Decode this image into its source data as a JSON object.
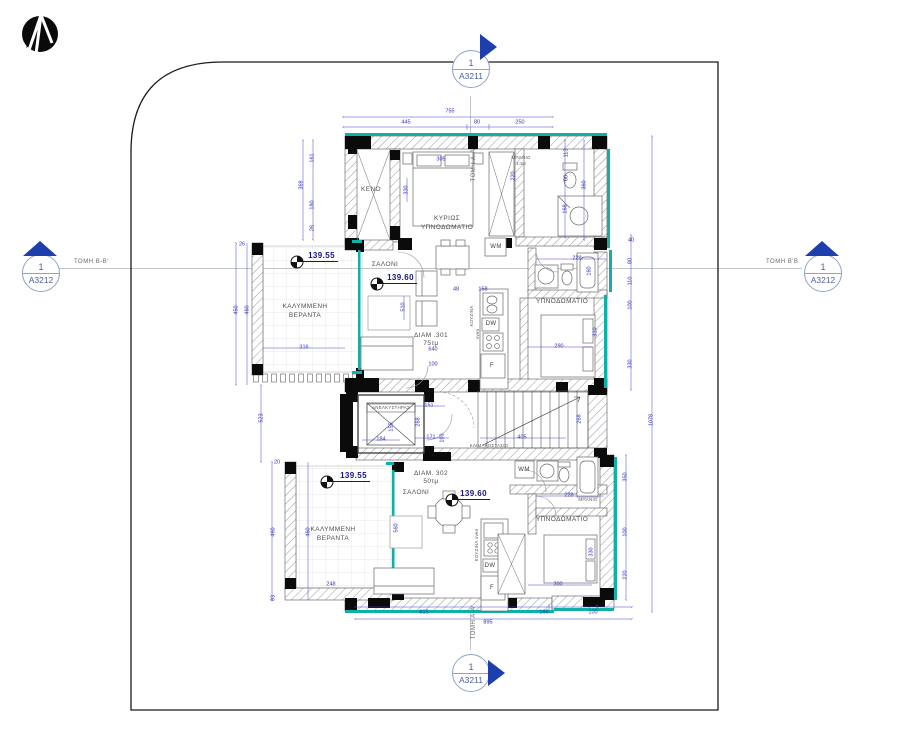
{
  "colors": {
    "dimension_blue": "#2f2fbe",
    "marker_blue": "#1d3fae",
    "wall_teal": "#0fb0a6",
    "level_navy": "#15157e"
  },
  "logo": {
    "name": "architect-logo"
  },
  "section_markers": {
    "top": {
      "number": "1",
      "sheet": "A3211",
      "label": "ΤΟΜΗ Α-Α"
    },
    "bottom": {
      "number": "1",
      "sheet": "A3211",
      "label": "ΤΟΜΗ Α-Α'"
    },
    "left": {
      "number": "1",
      "sheet": "A3212",
      "label": "ΤΟΜΗ Β-Β'"
    },
    "right": {
      "number": "1",
      "sheet": "A3212",
      "label": "ΤΟΜΗ Β'Β"
    }
  },
  "plan": {
    "apartments": [
      {
        "name": "ΔΙΑΜ .301",
        "area": "75τμ"
      },
      {
        "name": "ΔΙΑΜ. 302",
        "area": "50τμ"
      }
    ],
    "rooms": [
      {
        "t": "ΚΕΝΟ",
        "x": 371,
        "y": 190,
        "cls": "room"
      },
      {
        "t": "ΚΥΡΙΩΣ",
        "x": 447,
        "y": 219,
        "cls": "room"
      },
      {
        "t": "ΥΠΝΟΔΩΜΑΤΙΟ",
        "x": 447,
        "y": 228,
        "cls": "room"
      },
      {
        "t": "ΜΠΑΝΙΟ",
        "x": 521,
        "y": 158,
        "cls": "tiny"
      },
      {
        "t": "1:50",
        "x": 521,
        "y": 164,
        "cls": "tiny"
      },
      {
        "t": "ΣΑΛΟΝΙ",
        "x": 385,
        "y": 265,
        "cls": "room"
      },
      {
        "t": "ΚΑΛΥΜΜΕΝΗ",
        "x": 305,
        "y": 307,
        "cls": "room"
      },
      {
        "t": "ΒΕΡΑΝΤΑ",
        "x": 305,
        "y": 316,
        "cls": "room"
      },
      {
        "t": "ΥΠΝΟΔΩΜΑΤΙΟ",
        "x": 562,
        "y": 302,
        "cls": "room"
      },
      {
        "t": "ΔΙΑΜ .301",
        "x": 431,
        "y": 336,
        "cls": "room"
      },
      {
        "t": "75τμ",
        "x": 431,
        "y": 344,
        "cls": "room"
      },
      {
        "t": "ΚΟΥΖΙΝΑ",
        "x": 472,
        "y": 316,
        "cls": "tiny",
        "r": 1
      },
      {
        "t": "oven",
        "x": 478,
        "y": 334,
        "cls": "tiny",
        "r": 1
      },
      {
        "t": "ΑΝΕΛΚΥΣΤΗΡΑΣ",
        "x": 391,
        "y": 408,
        "cls": "tiny"
      },
      {
        "t": "ΚΛΙΜΑΚΟΣΤΑΣΙΟ",
        "x": 489,
        "y": 446,
        "cls": "tiny"
      },
      {
        "t": "ΔΙΑΜ. 302",
        "x": 431,
        "y": 474,
        "cls": "room"
      },
      {
        "t": "50τμ",
        "x": 431,
        "y": 482,
        "cls": "room"
      },
      {
        "t": "ΣΑΛΟΝΙ",
        "x": 416,
        "y": 493,
        "cls": "room"
      },
      {
        "t": "ΚΑΛΥΜΜΕΝΗ",
        "x": 333,
        "y": 530,
        "cls": "room"
      },
      {
        "t": "ΒΕΡΑΝΤΑ",
        "x": 333,
        "y": 539,
        "cls": "room"
      },
      {
        "t": "ΥΠΝΟΔΩΜΑΤΙΟ",
        "x": 562,
        "y": 520,
        "cls": "room"
      },
      {
        "t": "ΚΟΥΖΙΝΑ oven",
        "x": 477,
        "y": 545,
        "cls": "tiny",
        "r": 1
      },
      {
        "t": "ΜΠΑΝΙΟ",
        "x": 588,
        "y": 500,
        "cls": "tiny"
      }
    ],
    "appliances": [
      {
        "t": "WM",
        "x": 496,
        "y": 247
      },
      {
        "t": "DW",
        "x": 491,
        "y": 324
      },
      {
        "t": "F",
        "x": 492,
        "y": 366
      },
      {
        "t": "WM",
        "x": 524,
        "y": 470
      },
      {
        "t": "DW",
        "x": 490,
        "y": 566
      },
      {
        "t": "F",
        "x": 492,
        "y": 588
      }
    ],
    "levels": [
      {
        "v": "139.55",
        "x": 318,
        "y": 257,
        "sx": 297,
        "sy": 262
      },
      {
        "v": "139.60",
        "x": 397,
        "y": 279,
        "sx": 377,
        "sy": 284
      },
      {
        "v": "139.55",
        "x": 350,
        "y": 477,
        "sx": 327,
        "sy": 482
      },
      {
        "v": "139.60",
        "x": 470,
        "y": 495,
        "sx": 452,
        "sy": 500
      }
    ],
    "dims": [
      {
        "t": "755",
        "x": 450,
        "y": 112
      },
      {
        "t": "445",
        "x": 406,
        "y": 123
      },
      {
        "t": "80",
        "x": 477,
        "y": 123
      },
      {
        "t": "250",
        "x": 520,
        "y": 123
      },
      {
        "t": "161",
        "x": 313,
        "y": 158,
        "r": 1
      },
      {
        "t": "369",
        "x": 302,
        "y": 185,
        "r": 1
      },
      {
        "t": "180",
        "x": 313,
        "y": 205,
        "r": 1
      },
      {
        "t": "26",
        "x": 313,
        "y": 228,
        "r": 1
      },
      {
        "t": "305",
        "x": 441,
        "y": 160
      },
      {
        "t": "330",
        "x": 407,
        "y": 190,
        "r": 1
      },
      {
        "t": "220",
        "x": 514,
        "y": 176,
        "r": 1
      },
      {
        "t": "113",
        "x": 567,
        "y": 153,
        "r": 1
      },
      {
        "t": "60",
        "x": 567,
        "y": 178,
        "r": 1
      },
      {
        "t": "168",
        "x": 566,
        "y": 209,
        "r": 1
      },
      {
        "t": "360",
        "x": 585,
        "y": 185,
        "r": 1
      },
      {
        "t": "40",
        "x": 631,
        "y": 241
      },
      {
        "t": "80",
        "x": 631,
        "y": 261,
        "r": 1
      },
      {
        "t": "110",
        "x": 631,
        "y": 281,
        "r": 1
      },
      {
        "t": "100",
        "x": 631,
        "y": 305,
        "r": 1
      },
      {
        "t": "330",
        "x": 631,
        "y": 364,
        "r": 1
      },
      {
        "t": "1078",
        "x": 652,
        "y": 420,
        "r": 1
      },
      {
        "t": "510",
        "x": 404,
        "y": 307,
        "r": 1
      },
      {
        "t": "48",
        "x": 456,
        "y": 290
      },
      {
        "t": "158",
        "x": 483,
        "y": 290
      },
      {
        "t": "640",
        "x": 433,
        "y": 350
      },
      {
        "t": "100",
        "x": 433,
        "y": 365
      },
      {
        "t": "290",
        "x": 559,
        "y": 347
      },
      {
        "t": "228",
        "x": 577,
        "y": 259
      },
      {
        "t": "160",
        "x": 590,
        "y": 271,
        "r": 1
      },
      {
        "t": "310",
        "x": 596,
        "y": 332,
        "r": 1
      },
      {
        "t": "450",
        "x": 237,
        "y": 310,
        "r": 1
      },
      {
        "t": "460",
        "x": 248,
        "y": 310,
        "r": 1
      },
      {
        "t": "316",
        "x": 304,
        "y": 348
      },
      {
        "t": "26",
        "x": 242,
        "y": 245
      },
      {
        "t": "523",
        "x": 262,
        "y": 418,
        "r": 1
      },
      {
        "t": "20",
        "x": 277,
        "y": 463
      },
      {
        "t": "151",
        "x": 429,
        "y": 406
      },
      {
        "t": "268",
        "x": 419,
        "y": 422,
        "r": 1
      },
      {
        "t": "171",
        "x": 431,
        "y": 438
      },
      {
        "t": "103",
        "x": 443,
        "y": 438,
        "r": 1
      },
      {
        "t": "184",
        "x": 381,
        "y": 440
      },
      {
        "t": "155",
        "x": 392,
        "y": 427,
        "r": 1
      },
      {
        "t": "405",
        "x": 522,
        "y": 438
      },
      {
        "t": "268",
        "x": 580,
        "y": 419,
        "r": 1
      },
      {
        "t": "460",
        "x": 274,
        "y": 532,
        "r": 1
      },
      {
        "t": "460",
        "x": 309,
        "y": 532,
        "r": 1
      },
      {
        "t": "248",
        "x": 331,
        "y": 585
      },
      {
        "t": "93",
        "x": 274,
        "y": 598,
        "r": 1
      },
      {
        "t": "560",
        "x": 397,
        "y": 528,
        "r": 1
      },
      {
        "t": "228",
        "x": 569,
        "y": 496
      },
      {
        "t": "330",
        "x": 592,
        "y": 552,
        "r": 1
      },
      {
        "t": "300",
        "x": 558,
        "y": 585
      },
      {
        "t": "350",
        "x": 626,
        "y": 477,
        "r": 1
      },
      {
        "t": "100",
        "x": 626,
        "y": 532,
        "r": 1
      },
      {
        "t": "220",
        "x": 626,
        "y": 575,
        "r": 1
      },
      {
        "t": "615",
        "x": 424,
        "y": 613
      },
      {
        "t": "160",
        "x": 544,
        "y": 613
      },
      {
        "t": "100",
        "x": 593,
        "y": 613
      },
      {
        "t": "895",
        "x": 488,
        "y": 623
      }
    ]
  }
}
